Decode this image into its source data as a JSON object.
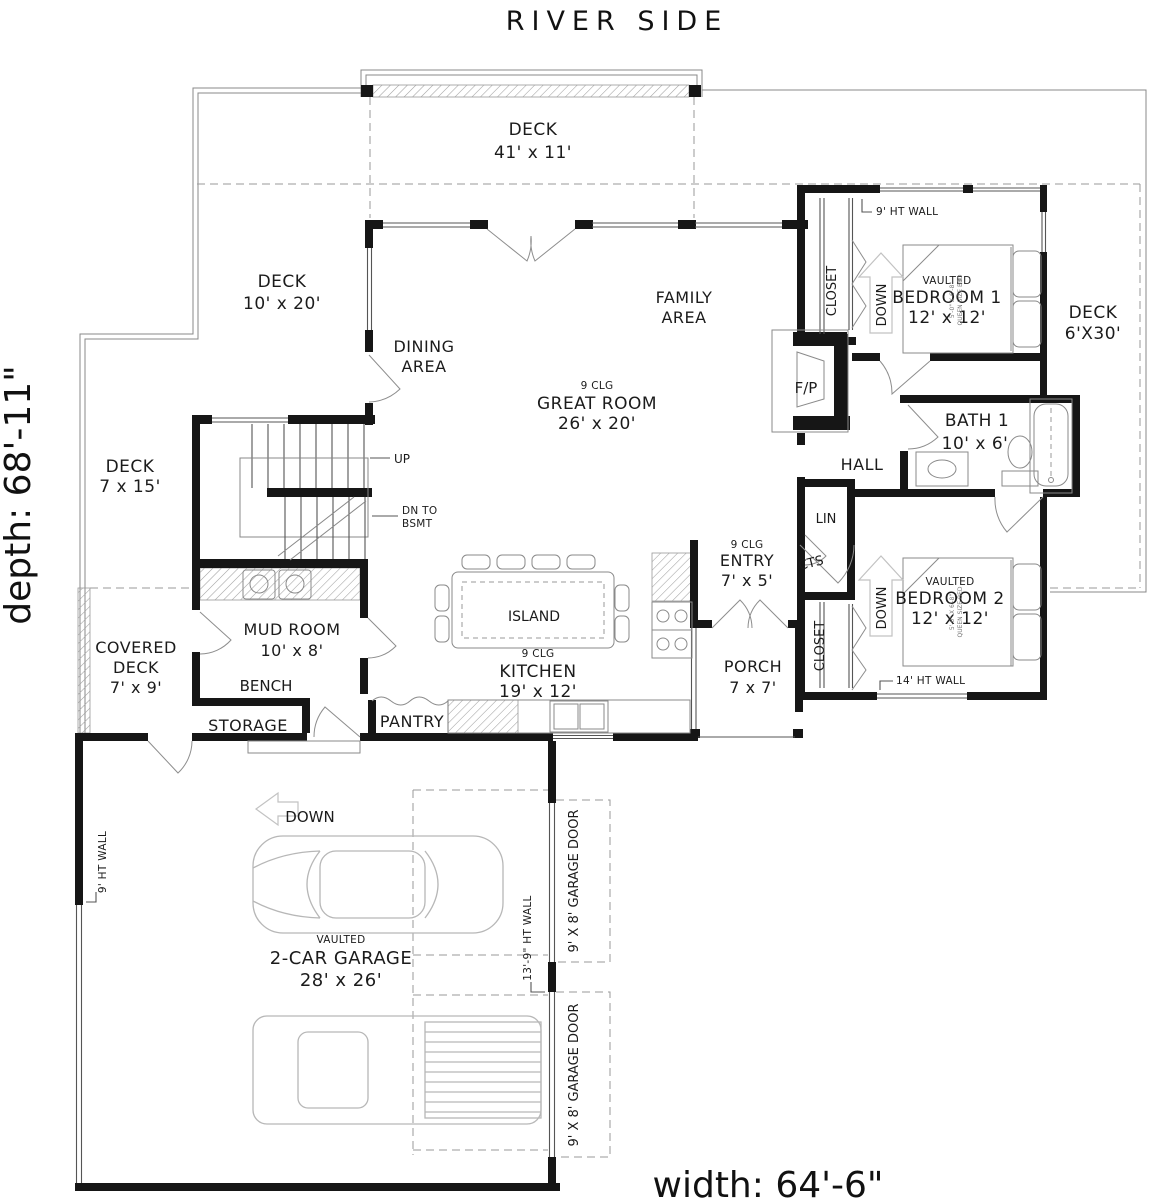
{
  "plan": {
    "site": "RIVER SIDE",
    "width": "width: 64'-6\"",
    "depth": "depth: 68'-11\""
  },
  "rooms": {
    "deck_river": {
      "name": "DECK",
      "dims": "41' x 11'"
    },
    "deck_left": {
      "name": "DECK",
      "dims": "10' x 20'"
    },
    "deck_side": {
      "name": "DECK",
      "dims": "7 x 15'"
    },
    "deck_right": {
      "name": "DECK",
      "dims": "6'X30'"
    },
    "covered_deck": {
      "l1": "COVERED",
      "l2": "DECK",
      "dims": "7' x 9'"
    },
    "dining": {
      "l1": "DINING",
      "l2": "AREA"
    },
    "family": {
      "l1": "FAMILY",
      "l2": "AREA"
    },
    "great_room": {
      "clg": "9 CLG",
      "name": "GREAT ROOM",
      "dims": "26' x 20'"
    },
    "kitchen": {
      "clg": "9 CLG",
      "name": "KITCHEN",
      "dims": "19' x 12'"
    },
    "entry": {
      "clg": "9 CLG",
      "name": "ENTRY",
      "dims": "7' x 5'"
    },
    "island": {
      "name": "ISLAND"
    },
    "pantry": {
      "name": "PANTRY"
    },
    "mud_room": {
      "name": "MUD ROOM",
      "dims": "10' x 8'"
    },
    "bench": {
      "name": "BENCH"
    },
    "storage": {
      "name": "STORAGE"
    },
    "porch": {
      "name": "PORCH",
      "dims": "7 x 7'"
    },
    "bedroom1": {
      "v": "VAULTED",
      "name": "BEDROOM 1",
      "dims": "12' x 12'"
    },
    "bedroom2": {
      "v": "VAULTED",
      "name": "BEDROOM 2",
      "dims": "12' x 12'"
    },
    "bath1": {
      "name": "BATH 1",
      "dims": "10' x 6'"
    },
    "hall": {
      "name": "HALL"
    },
    "garage": {
      "v": "VAULTED",
      "name": "2-CAR GARAGE",
      "dims": "28' x 26'"
    },
    "closet1": {
      "name": "CLOSET"
    },
    "closet2": {
      "name": "CLOSET"
    },
    "lin": {
      "name": "LIN"
    },
    "cts": {
      "name": "CTS"
    },
    "fireplace": {
      "name": "F/P"
    }
  },
  "annotations": {
    "up": "UP",
    "dn1": "DN TO",
    "dn2": "BSMT",
    "down_bed1": "DOWN",
    "down_bed2": "DOWN",
    "down_garage": "DOWN",
    "wall9_bed1": "9' HT WALL",
    "wall14": "14' HT WALL",
    "wall9_garage": "9' HT WALL",
    "wall139": "13'-9\" HT WALL",
    "garage_door1": "9' X 8' GARAGE DOOR",
    "garage_door2": "9' X 8' GARAGE DOOR",
    "bed_size": "5'-0\" X 6'-8\"",
    "bed_type": "QUEEN SIZE BED"
  }
}
